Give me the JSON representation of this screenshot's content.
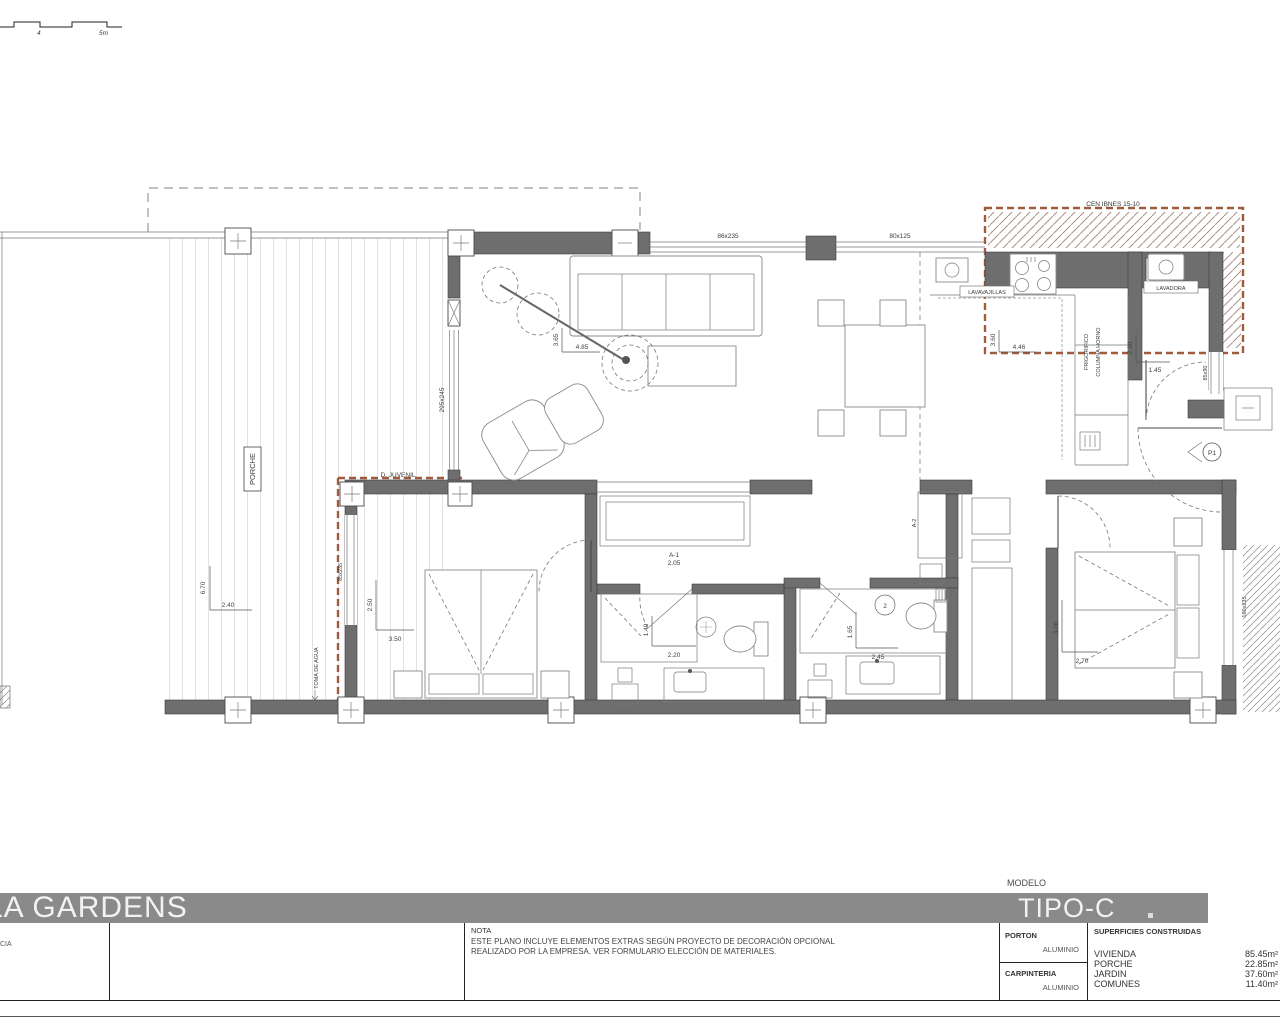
{
  "titlebar": {
    "project": "LA GARDENS",
    "modelo_label": "MODELO",
    "modelo": "TIPO-C"
  },
  "titleblock": {
    "left_partial": "CIA",
    "nota_label": "NOTA",
    "nota_line1": "ESTE PLANO INCLUYE ELEMENTOS EXTRAS SEGÚN PROYECTO DE DECORACIÓN OPCIONAL",
    "nota_line2": "REALIZADO POR LA EMPRESA. VER FORMULARIO ELECCIÓN DE MATERIALES.",
    "porton_label": "PORTON",
    "porton_value": "ALUMINIO",
    "carpinteria_label": "CARPINTERIA",
    "carpinteria_value": "ALUMINIO",
    "superficies_label": "SUPERFICIES CONSTRUIDAS",
    "superficies": [
      {
        "name": "VIVIENDA",
        "value": "85.45m²"
      },
      {
        "name": "PORCHE",
        "value": "22.85m²"
      },
      {
        "name": "JARDIN",
        "value": "37.60m²"
      },
      {
        "name": "COMUNES",
        "value": "11.40m²"
      }
    ]
  },
  "scalebar": {
    "label_4": "4",
    "label_5m": "5m"
  },
  "plan": {
    "porch_label": "PORCHE",
    "toma_agua": "TOMA DE AGUA",
    "top_zone_label": "CEN IBNES 15-10",
    "garden_note": "D. JUVENIL",
    "dishwasher": "LAVAVAJILLAS",
    "washer": "LAVADORA",
    "fridge": "FRIGORIFICO",
    "oven": "COLUMNA HORNO",
    "win_top_left": "86x235",
    "win_top_right": "80x125",
    "win_living": "295x245",
    "win_bed1": "85x235",
    "win_bed2": "160x235",
    "win_entry": "85x90",
    "wardrobe1_ref": "A-1",
    "wardrobe1_dim": "2.05",
    "wardrobe2_ref": "A-2",
    "door_ref": "P1",
    "bath2_ref": "2",
    "dims": {
      "porch_v": "6.70",
      "porch_h": "2.40",
      "living_v": "3.65",
      "living_h": "4.85",
      "kitchen_v": "3.60",
      "kitchen_h": "4.46",
      "hall_v": "2.30",
      "hall_h": "1.45",
      "bed1_v": "2.50",
      "bed1_h": "3.50",
      "bath1_v": "1.40",
      "bath1_h": "2.20",
      "bath2_v": "1.65",
      "bath2_h": "2.45",
      "bed2_v": "3.06",
      "bed2_h": "2.70"
    }
  }
}
